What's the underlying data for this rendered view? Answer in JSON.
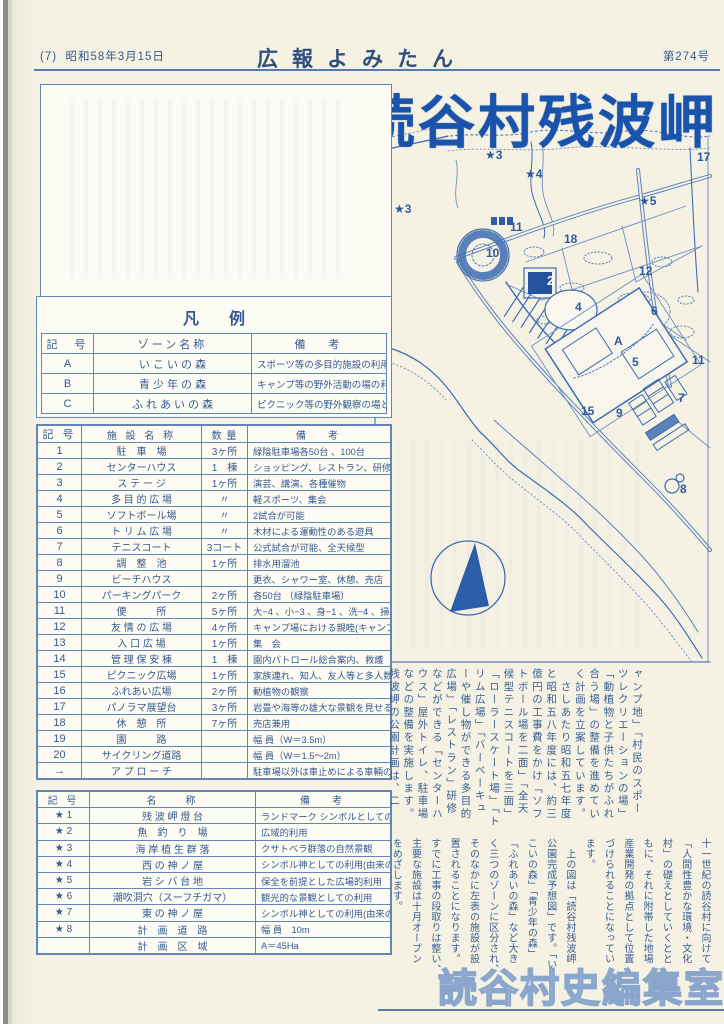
{
  "page": {
    "edition_note": "(7)",
    "date": "昭和58年3月15日",
    "masthead": "広報よみたん",
    "issue_no": "第274号",
    "main_title": "読谷村残波岬",
    "stamp": "読谷村史編集室"
  },
  "legend": {
    "title": "凡例",
    "zone_table": {
      "headers": [
        "記　号",
        "ゾーン名称",
        "備　考"
      ],
      "rows": [
        {
          "sign": "A",
          "name": "い こ い の 森",
          "note": "スポーツ等の多目的施設の利用"
        },
        {
          "sign": "B",
          "name": "青 少 年 の 森",
          "note": "キャンプ等の野外活動の場の利用"
        },
        {
          "sign": "C",
          "name": "ふ れ あ い の 森",
          "note": "ピクニック等の野外観察の場としての利用"
        }
      ]
    },
    "facility_table": {
      "headers": [
        "記 号",
        "施 設 名 称",
        "数 量",
        "備　考"
      ],
      "rows": [
        {
          "sign": "1",
          "name": "駐　車　場",
          "qty": "3ヶ所",
          "note": "緑陰駐車場各50台 、100台"
        },
        {
          "sign": "2",
          "name": "センターハウス",
          "qty": "1　棟",
          "note": "ショッピング、レストラン、研修等"
        },
        {
          "sign": "3",
          "name": "ス テ ー ジ",
          "qty": "1ヶ所",
          "note": "演芸、講演、各種催物"
        },
        {
          "sign": "4",
          "name": "多 目 的 広 場",
          "qty": "〃",
          "note": "軽スポーツ、集会"
        },
        {
          "sign": "5",
          "name": "ソフトボール場",
          "qty": "〃",
          "note": "2試合が可能"
        },
        {
          "sign": "6",
          "name": "ト リ ム 広 場",
          "qty": "〃",
          "note": "木材による運動性のある遊具"
        },
        {
          "sign": "7",
          "name": "テニスコート",
          "qty": "3コート",
          "note": "公式試合が可能、全天候型"
        },
        {
          "sign": "8",
          "name": "調　整　池",
          "qty": "1ヶ所",
          "note": "排水用溜池"
        },
        {
          "sign": "9",
          "name": "ビーチハウス",
          "qty": "",
          "note": "更衣、シャワー室、休憩、売店"
        },
        {
          "sign": "10",
          "name": "パーキングパーク",
          "qty": "2ヶ所",
          "note": "各50台 （緑陰駐車場）"
        },
        {
          "sign": "11",
          "name": "便　　　所",
          "qty": "5ヶ所",
          "note": "大−4 、小−3 、身−1 、洗−4 、掃−1"
        },
        {
          "sign": "12",
          "name": "友 情 の 広 場",
          "qty": "4ヶ所",
          "note": "キャンプ場における親睦(キャンプファイア等)"
        },
        {
          "sign": "13",
          "name": "入 口 広 場",
          "qty": "1ヶ所",
          "note": "集　会"
        },
        {
          "sign": "14",
          "name": "管 理 保 安 棟",
          "qty": "1　棟",
          "note": "園内パトロール総合案内、救護"
        },
        {
          "sign": "15",
          "name": "ピクニック広場",
          "qty": "1ヶ所",
          "note": "家族連れ、知人、友人等と多人数の利用"
        },
        {
          "sign": "16",
          "name": "ふれあい広場",
          "qty": "2ヶ所",
          "note": "動植物の観察"
        },
        {
          "sign": "17",
          "name": "パノラマ展望台",
          "qty": "3ヶ所",
          "note": "岩畳や海等の雄大な景観を見せる"
        },
        {
          "sign": "18",
          "name": "休　憩　所",
          "qty": "7ヶ所",
          "note": "売店兼用"
        },
        {
          "sign": "19",
          "name": "園　　　路",
          "qty": "",
          "note": "幅 員（W＝3.5m）"
        },
        {
          "sign": "20",
          "name": "サイクリング道路",
          "qty": "",
          "note": "幅 員（W＝1.5〜2m）"
        },
        {
          "sign": "→",
          "name": "ア プ ロ ー チ",
          "qty": "",
          "note": "駐車場以外は車止めによる車輛の締出し"
        }
      ]
    },
    "landmark_table": {
      "headers": [
        "記 号",
        "名　　称",
        "備　考"
      ],
      "rows": [
        {
          "sign": "★ 1",
          "name": "残 波 岬 燈 台",
          "note": "ランドマーク シンボルとしての利用"
        },
        {
          "sign": "★ 2",
          "name": "魚　釣　り　場",
          "note": "広域的利用"
        },
        {
          "sign": "★ 3",
          "name": "海 岸 植 生 群 落",
          "note": "クサトベラ群落の自然景観"
        },
        {
          "sign": "★ 4",
          "name": "西 の 神 ノ 屋",
          "note": "シンボル神としての利用(由来の銘記)"
        },
        {
          "sign": "★ 5",
          "name": "岩 シ バ 台 地",
          "note": "保全を前提とした広場的利用"
        },
        {
          "sign": "★ 6",
          "name": "潮吹洞穴（スーフチガマ）",
          "note": "観光的な景観としての利用"
        },
        {
          "sign": "★ 7",
          "name": "東 の 神 ノ 屋",
          "note": "シンボル神としての利用(由来の銘記)"
        },
        {
          "sign": "★ 8",
          "name": "計　画　道　路",
          "note": "幅 員　10m"
        },
        {
          "sign": "",
          "name": "計　画　区　域",
          "note": "A＝45Ha"
        }
      ]
    }
  },
  "map": {
    "ink_color": "#2d5a9e",
    "compass": "north-arrow",
    "labels": [
      {
        "text": "★3",
        "x": 487,
        "y": 150
      },
      {
        "text": "★3",
        "x": 396,
        "y": 204
      },
      {
        "text": "★4",
        "x": 527,
        "y": 169
      },
      {
        "text": "★5",
        "x": 641,
        "y": 196
      },
      {
        "text": "17",
        "x": 699,
        "y": 152
      },
      {
        "text": "11",
        "x": 512,
        "y": 222
      },
      {
        "text": "10",
        "x": 488,
        "y": 248
      },
      {
        "text": "18",
        "x": 566,
        "y": 234
      },
      {
        "text": "12",
        "x": 641,
        "y": 266
      },
      {
        "text": "2",
        "x": 549,
        "y": 275,
        "inv": true
      },
      {
        "text": "4",
        "x": 577,
        "y": 302
      },
      {
        "text": "6",
        "x": 653,
        "y": 306
      },
      {
        "text": "A",
        "x": 616,
        "y": 336
      },
      {
        "text": "5",
        "x": 634,
        "y": 357
      },
      {
        "text": "11",
        "x": 694,
        "y": 355
      },
      {
        "text": "7",
        "x": 680,
        "y": 393
      },
      {
        "text": "15",
        "x": 583,
        "y": 406
      },
      {
        "text": "9",
        "x": 618,
        "y": 408
      },
      {
        "text": "8",
        "x": 682,
        "y": 484
      }
    ]
  },
  "article": {
    "tier1_lines": [
      "ャンプ地」「村民のスポー",
      "ツレクリエーションの場」",
      "「動植物と子供たちがふれ",
      "合う場」の整備を進めてい",
      "く計画を立案しています。",
      "　さしあたり昭和五七年度",
      "と昭和五八年度には、約三",
      "億円の工事費をかけ「ソフ",
      "トボール場を二面」「全天",
      "候型テニスコートを三面」",
      "「ローラースケート場」「ト",
      "リム広場」「バーベーキュ",
      "ーや催し物ができる多目的",
      "広場」「レストラン」研修",
      "などができる「センターハ",
      "ウス」屋外トイレ、駐車場",
      "などの整備を実施します。",
      "残波岬の公園計画は、二"
    ],
    "tier2_lines": [
      "十一世紀の読谷村に向けて",
      "「人間性豊かな環境・文化",
      "村」の礎えとしていくとと",
      "もに、それに附帯した地場",
      "産業開発の拠点として位置",
      "づけられることになってい",
      "ます。",
      "　上の図は「読谷村残波岬",
      "公園完成予想図」です。「い",
      "こいの森」「青少年の森」",
      "「ふれあいの森」など大き",
      "く三つのゾーンに区分され、",
      "そのなかに左表の施設が設",
      "置されることになります。",
      "すでに工事の段取りは整い、",
      "主要な施設は十月オープン",
      "をめざします。"
    ]
  }
}
